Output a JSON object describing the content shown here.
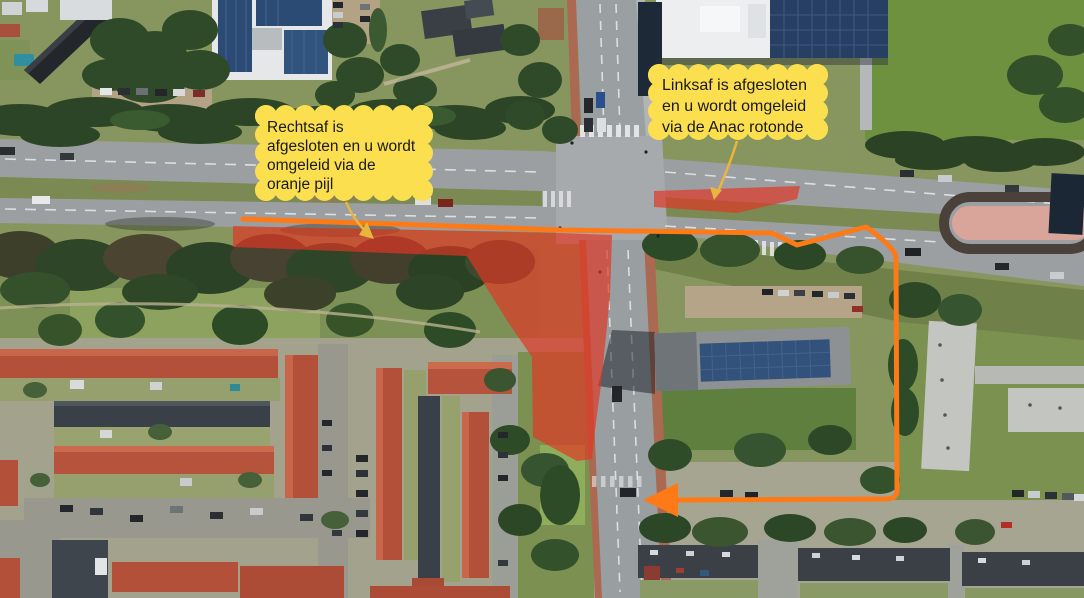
{
  "annotations": {
    "callouts": [
      {
        "id": "rechtsaf",
        "full_text": "Rechtsaf is afgesloten en u wordt omgeleid via de oranje pijl",
        "lines": [
          "Rechtsaf is",
          "afgesloten en u wordt",
          "omgeleid via de",
          "oranje pijl"
        ]
      },
      {
        "id": "linksaf",
        "full_text": "Linksaf is afgesloten en u wordt omgeleid via de Anac rotonde",
        "lines": [
          "Linksaf is afgesloten",
          "en u wordt omgeleid",
          "via de Anac rotonde"
        ]
      }
    ],
    "colors": {
      "closure_red": "#e13524",
      "detour_orange": "#fd7a17",
      "callout_yellow": "#fcdf4f",
      "callout_pointer": "#e9b53d",
      "callout_text": "#191919"
    }
  }
}
